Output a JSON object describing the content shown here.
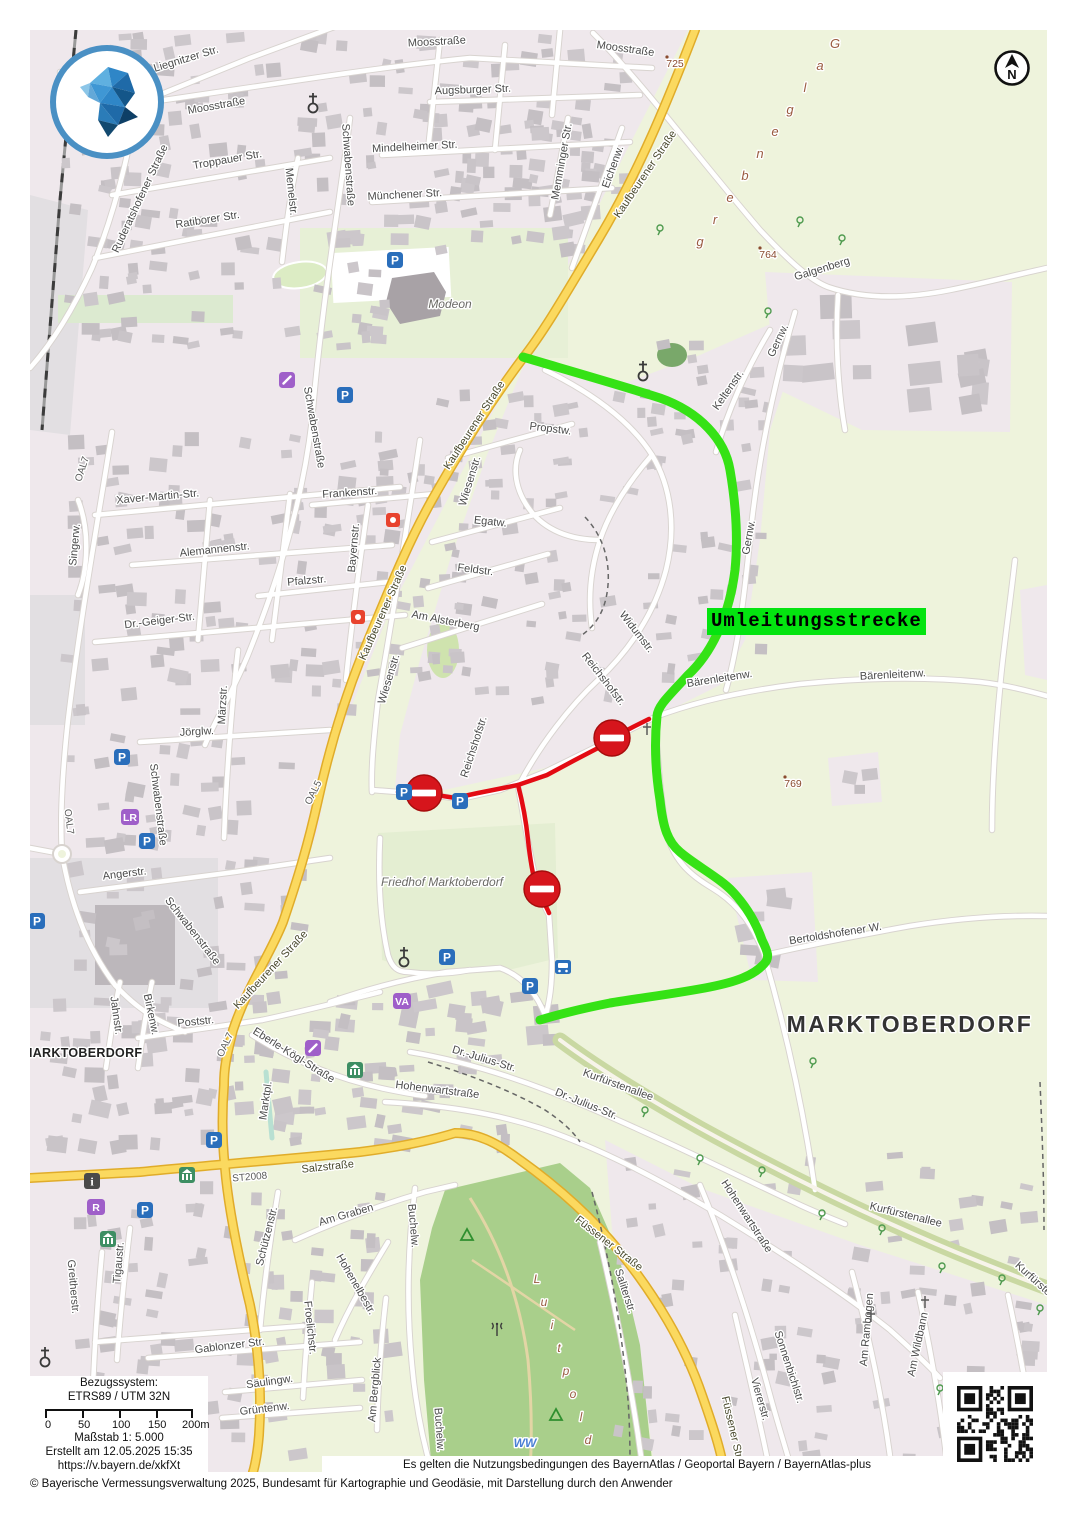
{
  "app": {
    "name": "BayernAtlas map print"
  },
  "compass": {
    "letter": "N"
  },
  "detour": {
    "label": "Umleitungsstrecke",
    "label_bg": "#04e410",
    "route_color": "#35e215",
    "closure_color": "#e30b13",
    "no_entry_sign_color": "#d6151c",
    "no_entry_signs": [
      [
        424,
        793
      ],
      [
        612,
        738
      ],
      [
        542,
        889
      ]
    ]
  },
  "town": {
    "large": "MARKTOBERDORF",
    "small": "MARKTOBERDORF"
  },
  "scalebox": {
    "ref_title": "Bezugssystem:",
    "ref_value": "ETRS89 / UTM 32N",
    "ticks": [
      "0",
      "50",
      "100",
      "150",
      "200m"
    ],
    "scale_text": "Maßstab 1: 5.000",
    "created_text": "Erstellt am 12.05.2025 15:35",
    "url_text": "https://v.bayern.de/xkfXt"
  },
  "footer": {
    "terms": "Es gelten die Nutzungsbedingungen des BayernAtlas / Geoportal Bayern / BayernAtlas-plus",
    "copyright": "© Bayerische Vermessungsverwaltung 2025, Bundesamt für Kartographie und Geodäsie, mit Darstellung durch den Anwender"
  },
  "colors": {
    "urban": "#efe8ec",
    "field": "#eef3dc",
    "park": "#a9cf8b",
    "cemetery": "#e4eed2",
    "road_major_fill": "#fbd95f",
    "road_major_casing": "#e0ac2a",
    "road_minor_fill": "#ffffff",
    "road_minor_casing": "#d8d3cf",
    "building": "#c9c4c8",
    "gray_zone": "#e2dfe2",
    "label": "#4b4b4b",
    "parking_blue": "#2a6ebb",
    "poi_purple": "#9f5fc9",
    "museum_green": "#3d8e63",
    "elevation_brown": "#8a4b2f",
    "area_brown": "#9a5b40"
  },
  "area_labels": [
    {
      "text": "Galgenberg",
      "x1": 835,
      "y1": 48,
      "x2": 700,
      "y2": 246,
      "size": 13
    },
    {
      "text": "Luitpold",
      "x1": 537,
      "y1": 1283,
      "x2": 588,
      "y2": 1444,
      "size": 12
    }
  ],
  "poi_labels": [
    {
      "t": "Modeon",
      "x": 450,
      "y": 308
    },
    {
      "t": "Friedhof Marktoberdorf",
      "x": 442,
      "y": 886
    },
    {
      "t": "WW",
      "x": 525,
      "y": 1447,
      "k": "water"
    }
  ],
  "elevations": [
    {
      "t": "725",
      "x": 675,
      "y": 67
    },
    {
      "t": "764",
      "x": 768,
      "y": 258
    },
    {
      "t": "769",
      "x": 793,
      "y": 787
    }
  ],
  "street_labels": [
    {
      "t": "Liegnitzer Str.",
      "x": 187,
      "y": 62,
      "r": -17
    },
    {
      "t": "Moosstraße",
      "x": 217,
      "y": 109,
      "r": -10
    },
    {
      "t": "Moosstraße",
      "x": 437,
      "y": 45,
      "r": -3
    },
    {
      "t": "Moosstraße",
      "x": 625,
      "y": 52,
      "r": 8
    },
    {
      "t": "Augsburger Str.",
      "x": 473,
      "y": 93,
      "r": -2
    },
    {
      "t": "Mindelheimer Str.",
      "x": 415,
      "y": 150,
      "r": -3
    },
    {
      "t": "Münchener Str.",
      "x": 405,
      "y": 198,
      "r": -3
    },
    {
      "t": "Memminger Str.",
      "x": 565,
      "y": 162,
      "r": -80
    },
    {
      "t": "Eichenw.",
      "x": 616,
      "y": 168,
      "r": -70
    },
    {
      "t": "Troppauer Str.",
      "x": 228,
      "y": 163,
      "r": -10
    },
    {
      "t": "Ratiborer Str.",
      "x": 208,
      "y": 223,
      "r": -9
    },
    {
      "t": "Memelstr.",
      "x": 288,
      "y": 192,
      "r": 84
    },
    {
      "t": "Ruderatshofener Straße",
      "x": 143,
      "y": 200,
      "r": -65
    },
    {
      "t": "Schwabenstraße",
      "x": 345,
      "y": 165,
      "r": 86
    },
    {
      "t": "Schwabenstraße",
      "x": 311,
      "y": 428,
      "r": 80
    },
    {
      "t": "Schwabenstraße",
      "x": 155,
      "y": 805,
      "r": 83
    },
    {
      "t": "Schwabenstraße",
      "x": 190,
      "y": 933,
      "r": 52
    },
    {
      "t": "Xaver-Martin-Str.",
      "x": 158,
      "y": 500,
      "r": -5
    },
    {
      "t": "Alemannenstr.",
      "x": 215,
      "y": 553,
      "r": -6
    },
    {
      "t": "Pfalzstr.",
      "x": 307,
      "y": 584,
      "r": -5
    },
    {
      "t": "Dr.-Geiger-Str.",
      "x": 160,
      "y": 624,
      "r": -7
    },
    {
      "t": "Frankenstr.",
      "x": 350,
      "y": 496,
      "r": -4
    },
    {
      "t": "Bayernstr.",
      "x": 357,
      "y": 548,
      "r": -85
    },
    {
      "t": "Märzstr.",
      "x": 226,
      "y": 705,
      "r": -87
    },
    {
      "t": "Singerw.",
      "x": 78,
      "y": 545,
      "r": -85
    },
    {
      "t": "OAL7",
      "x": 85,
      "y": 470,
      "r": -72,
      "k": "rd"
    },
    {
      "t": "OAL7",
      "x": 66,
      "y": 822,
      "r": 83,
      "k": "rd"
    },
    {
      "t": "OAL7",
      "x": 228,
      "y": 1046,
      "r": -65,
      "k": "rd"
    },
    {
      "t": "OAL5",
      "x": 316,
      "y": 794,
      "r": -63,
      "k": "rd"
    },
    {
      "t": "ST2008",
      "x": 250,
      "y": 1180,
      "r": -5,
      "k": "rd"
    },
    {
      "t": "Jörglw.",
      "x": 197,
      "y": 735,
      "r": -3
    },
    {
      "t": "Angerstr.",
      "x": 125,
      "y": 877,
      "r": -7
    },
    {
      "t": "Kaufbeurener Straße",
      "x": 648,
      "y": 176,
      "r": -56,
      "k": "yl"
    },
    {
      "t": "Kaufbeurener Straße",
      "x": 477,
      "y": 427,
      "r": -57,
      "k": "yl"
    },
    {
      "t": "Kaufbeurener Straße",
      "x": 386,
      "y": 614,
      "r": -66,
      "k": "yl"
    },
    {
      "t": "Kaufbeurener Straße",
      "x": 273,
      "y": 972,
      "r": -47,
      "k": "yl"
    },
    {
      "t": "Wiesenstr.",
      "x": 473,
      "y": 482,
      "r": -73
    },
    {
      "t": "Wiesenstr.",
      "x": 392,
      "y": 680,
      "r": -73
    },
    {
      "t": "Propstw.",
      "x": 550,
      "y": 432,
      "r": 7
    },
    {
      "t": "Egatw.",
      "x": 490,
      "y": 525,
      "r": 6
    },
    {
      "t": "Feldstr.",
      "x": 475,
      "y": 573,
      "r": 7
    },
    {
      "t": "Am Alsterberg",
      "x": 445,
      "y": 624,
      "r": 11
    },
    {
      "t": "Widumstr.",
      "x": 634,
      "y": 634,
      "r": 52
    },
    {
      "t": "Reichshofstr.",
      "x": 601,
      "y": 681,
      "r": 52
    },
    {
      "t": "Reichshofstr.",
      "x": 477,
      "y": 748,
      "r": -72
    },
    {
      "t": "Keltenstr.",
      "x": 731,
      "y": 392,
      "r": -55
    },
    {
      "t": "Gernw.",
      "x": 781,
      "y": 342,
      "r": -65
    },
    {
      "t": "Gernw.",
      "x": 752,
      "y": 538,
      "r": -80
    },
    {
      "t": "Galgenberg",
      "x": 823,
      "y": 272,
      "r": -17
    },
    {
      "t": "Bärenleitenw.",
      "x": 720,
      "y": 682,
      "r": -9
    },
    {
      "t": "Bärenleitenw.",
      "x": 893,
      "y": 678,
      "r": -3
    },
    {
      "t": "Bertoldshofener W.",
      "x": 836,
      "y": 937,
      "r": -9
    },
    {
      "t": "Eberle-Kögl-Straße",
      "x": 292,
      "y": 1058,
      "r": 32
    },
    {
      "t": "Marktpl.",
      "x": 269,
      "y": 1101,
      "r": -82
    },
    {
      "t": "Poststr.",
      "x": 196,
      "y": 1025,
      "r": -6
    },
    {
      "t": "Jahnstr.",
      "x": 113,
      "y": 1016,
      "r": 82
    },
    {
      "t": "Birkenw.",
      "x": 148,
      "y": 1015,
      "r": 78
    },
    {
      "t": "Salzstraße",
      "x": 328,
      "y": 1170,
      "r": -6,
      "k": "yl"
    },
    {
      "t": "Hohenwartstraße",
      "x": 437,
      "y": 1093,
      "r": 7
    },
    {
      "t": "Hohenwartstraße",
      "x": 744,
      "y": 1218,
      "r": 57
    },
    {
      "t": "Dr.-Julius-Str.",
      "x": 483,
      "y": 1062,
      "r": 17
    },
    {
      "t": "Dr.-Julius-Str.",
      "x": 585,
      "y": 1107,
      "r": 22
    },
    {
      "t": "Kurfürstenallee",
      "x": 617,
      "y": 1088,
      "r": 20
    },
    {
      "t": "Kurfürstenallee",
      "x": 905,
      "y": 1218,
      "r": 14
    },
    {
      "t": "Kurfürstenallee",
      "x": 1042,
      "y": 1291,
      "r": 42
    },
    {
      "t": "Füssener Straße",
      "x": 607,
      "y": 1246,
      "r": 38,
      "k": "yl"
    },
    {
      "t": "Füssener Straße",
      "x": 731,
      "y": 1437,
      "r": 77,
      "k": "yl"
    },
    {
      "t": "Saliterstr.",
      "x": 622,
      "y": 1292,
      "r": 72
    },
    {
      "t": "Sonnenbichlstr.",
      "x": 786,
      "y": 1368,
      "r": 72
    },
    {
      "t": "Viererstr.",
      "x": 757,
      "y": 1400,
      "r": 74
    },
    {
      "t": "Am Rambogen",
      "x": 870,
      "y": 1330,
      "r": -85
    },
    {
      "t": "Am Wildbann",
      "x": 921,
      "y": 1345,
      "r": -78
    },
    {
      "t": "Schützenstr.",
      "x": 270,
      "y": 1237,
      "r": -76
    },
    {
      "t": "Am Graben",
      "x": 347,
      "y": 1218,
      "r": -16
    },
    {
      "t": "Buchelw.",
      "x": 410,
      "y": 1226,
      "r": 85
    },
    {
      "t": "Buchelw.",
      "x": 436,
      "y": 1430,
      "r": 86
    },
    {
      "t": "Hohenelbestr.",
      "x": 353,
      "y": 1286,
      "r": 60
    },
    {
      "t": "Froelichstr.",
      "x": 307,
      "y": 1328,
      "r": 84
    },
    {
      "t": "Gablonzer Str.",
      "x": 230,
      "y": 1349,
      "r": -7
    },
    {
      "t": "Säulingw.",
      "x": 270,
      "y": 1385,
      "r": -8
    },
    {
      "t": "Grüntenw.",
      "x": 265,
      "y": 1412,
      "r": -7
    },
    {
      "t": "Greitherstr.",
      "x": 70,
      "y": 1287,
      "r": 85
    },
    {
      "t": "Tigaustr.",
      "x": 122,
      "y": 1263,
      "r": -85
    },
    {
      "t": "Am Bergblick",
      "x": 378,
      "y": 1390,
      "r": -85
    }
  ],
  "icons": {
    "parking": [
      [
        395,
        260
      ],
      [
        345,
        395
      ],
      [
        404,
        792
      ],
      [
        460,
        801
      ],
      [
        122,
        757
      ],
      [
        147,
        841
      ],
      [
        37,
        921
      ],
      [
        214,
        1140
      ],
      [
        145,
        1210
      ],
      [
        530,
        986
      ],
      [
        447,
        957
      ]
    ],
    "church": [
      [
        313,
        104
      ],
      [
        643,
        372
      ],
      [
        404,
        958
      ],
      [
        45,
        1358
      ]
    ],
    "museum": [
      [
        355,
        1070
      ],
      [
        187,
        1175
      ],
      [
        108,
        1239
      ]
    ],
    "info": [
      [
        92,
        1181
      ]
    ],
    "letter_badges": [
      {
        "t": "R",
        "x": 96,
        "y": 1207
      },
      {
        "t": "LR",
        "x": 130,
        "y": 817
      },
      {
        "t": "VA",
        "x": 402,
        "y": 1001
      }
    ],
    "pencil": [
      [
        313,
        1048
      ],
      [
        287,
        380
      ]
    ],
    "hydrant": [
      [
        393,
        520
      ],
      [
        358,
        617
      ]
    ],
    "bus": [
      [
        563,
        967
      ]
    ],
    "antenna": [
      [
        497,
        1330
      ]
    ],
    "viewpoint": [
      [
        467,
        1235
      ],
      [
        556,
        1415
      ]
    ],
    "crosses": [
      [
        647,
        729
      ],
      [
        871,
        1316
      ],
      [
        925,
        1302
      ]
    ],
    "trees": [
      [
        660,
        230
      ],
      [
        800,
        222
      ],
      [
        842,
        240
      ],
      [
        768,
        313
      ],
      [
        813,
        1063
      ],
      [
        645,
        1112
      ],
      [
        700,
        1160
      ],
      [
        762,
        1172
      ],
      [
        822,
        1215
      ],
      [
        882,
        1230
      ],
      [
        942,
        1268
      ],
      [
        1002,
        1280
      ],
      [
        1040,
        1310
      ],
      [
        940,
        1390
      ],
      [
        978,
        1420
      ]
    ]
  }
}
